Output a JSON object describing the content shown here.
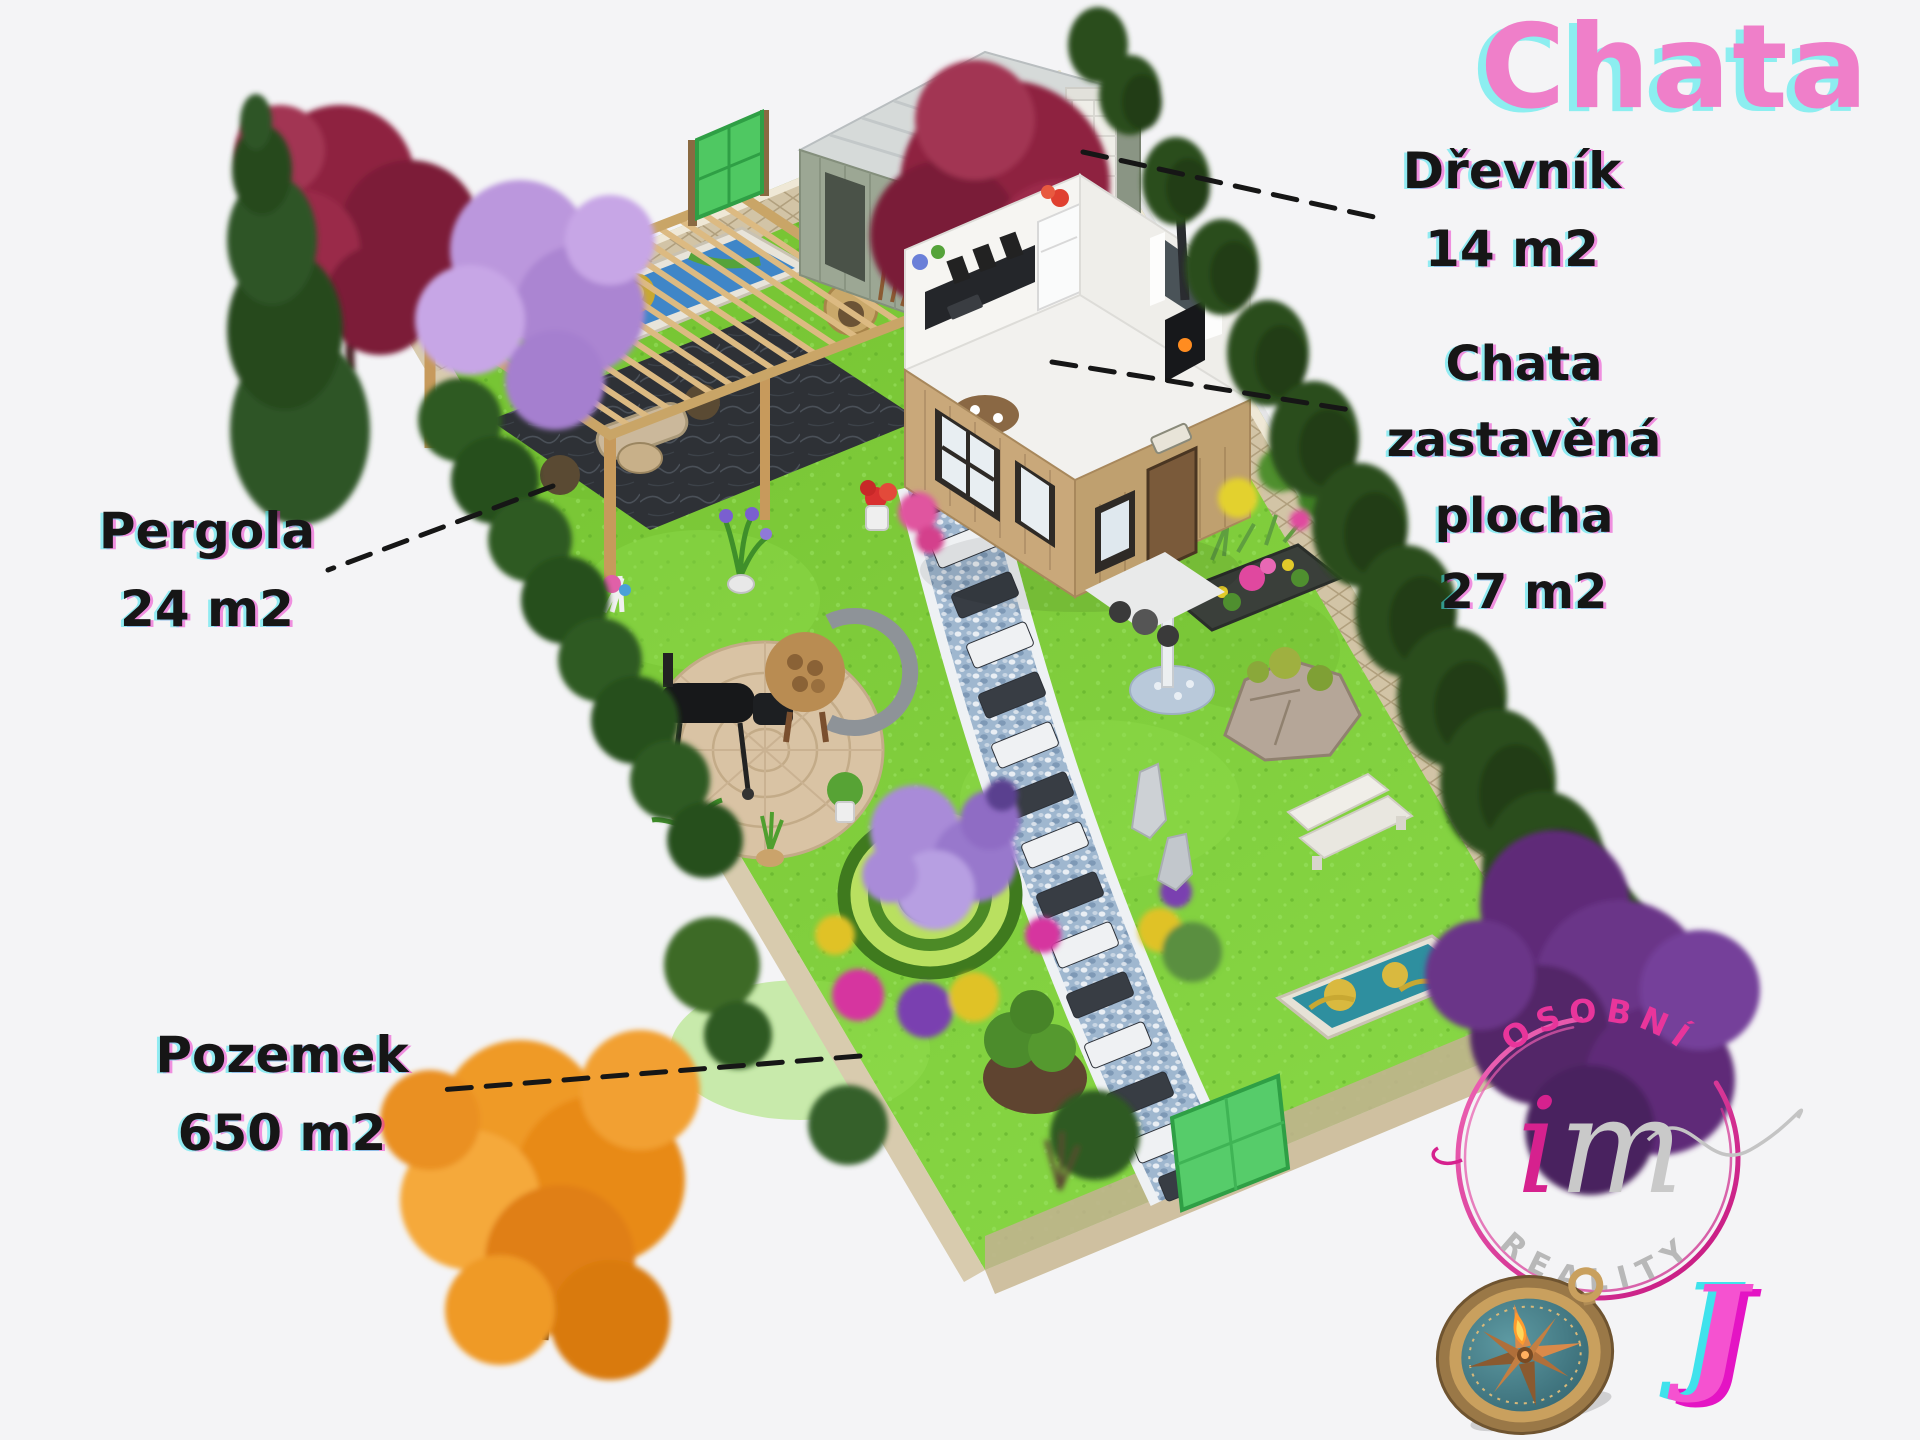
{
  "title": {
    "text": "Chata"
  },
  "annotations": {
    "drevnik": {
      "label": "Dřevník",
      "area": "14 m2"
    },
    "chata": {
      "label": "Chata",
      "sublabel": "zastavěná plocha",
      "area": "27 m2"
    },
    "pergola": {
      "label": "Pergola",
      "area": "24 m2"
    },
    "pozemek": {
      "label": "Pozemek",
      "area": "650 m2"
    }
  },
  "logo": {
    "arc_top": "OSOBNÍ",
    "script_i": "i",
    "script_m": "m",
    "arc_bottom": "REALITY",
    "monogram": "J"
  },
  "icons": {
    "compass": "compass-icon"
  },
  "colors": {
    "title_pink": "#ef7fc9",
    "title_cyan_shadow": "#8ceef0",
    "label_ink": "#161616",
    "aberration_cyan": "#40e4ee",
    "aberration_magenta": "#e814c4",
    "logo_pink": "#e8359b",
    "logo_gray": "#bdbdbd",
    "monogram_pink": "#f552d0",
    "lawn_green": "#7ecb3a",
    "wall_stone": "#d0c2a4",
    "path_pebble": "#a6bdd4"
  }
}
